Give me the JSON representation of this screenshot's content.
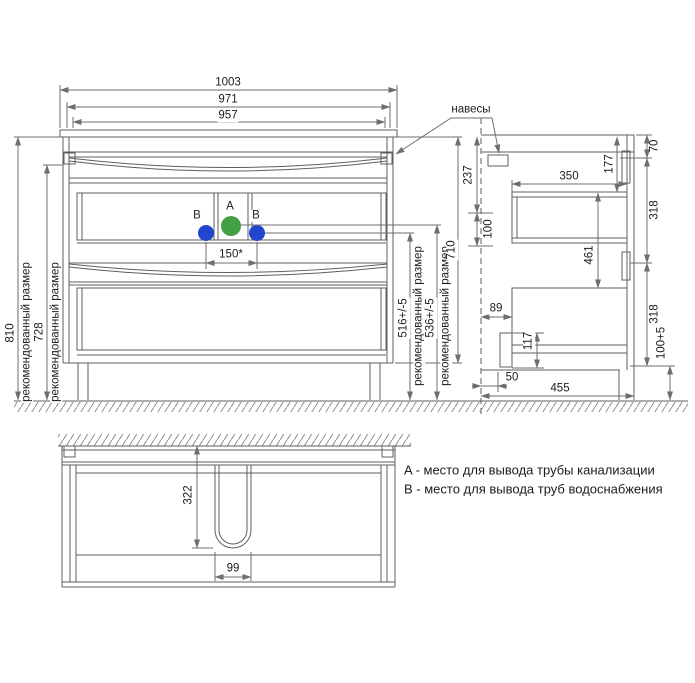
{
  "colors": {
    "line": "#5f5f5f",
    "dim": "#6e6e6e",
    "text": "#1c1c1c",
    "point_a": "#43a047",
    "point_b": "#2446cf",
    "background": "#ffffff"
  },
  "front_view": {
    "hangers_label": "навесы",
    "points": {
      "a": "A",
      "b_left": "B",
      "b_right": "B"
    },
    "dims": {
      "width_total": "1003",
      "width_outer": "971",
      "width_basin": "957",
      "height_total": "810",
      "height_to_top_rail": "728",
      "recommended_note": "рекомендованный размер",
      "supply_height": "516+/-5",
      "drain_height": "536+/-5",
      "cabinet_height": "710",
      "supply_spacing": "150*"
    }
  },
  "side_view": {
    "dims": {
      "top_to_handle": "70",
      "hanger_zone": "237",
      "top_to_drawer": "177",
      "drawer_depth": "350",
      "upper_panel": "318",
      "pipe_zone": "100",
      "drawer_spacing": "461",
      "wall_to_drawer": "89",
      "drawer_bottom": "117",
      "lower_panel": "318",
      "leg_height": "100+5",
      "wall_to_plinth": "50",
      "depth_total": "455"
    }
  },
  "plan_view": {
    "dims": {
      "cutout_depth": "322",
      "cutout_width": "99"
    }
  },
  "legend": {
    "line_a": "A - место для вывода трубы канализации",
    "line_b": "B - место для вывода труб водоснабжения"
  }
}
